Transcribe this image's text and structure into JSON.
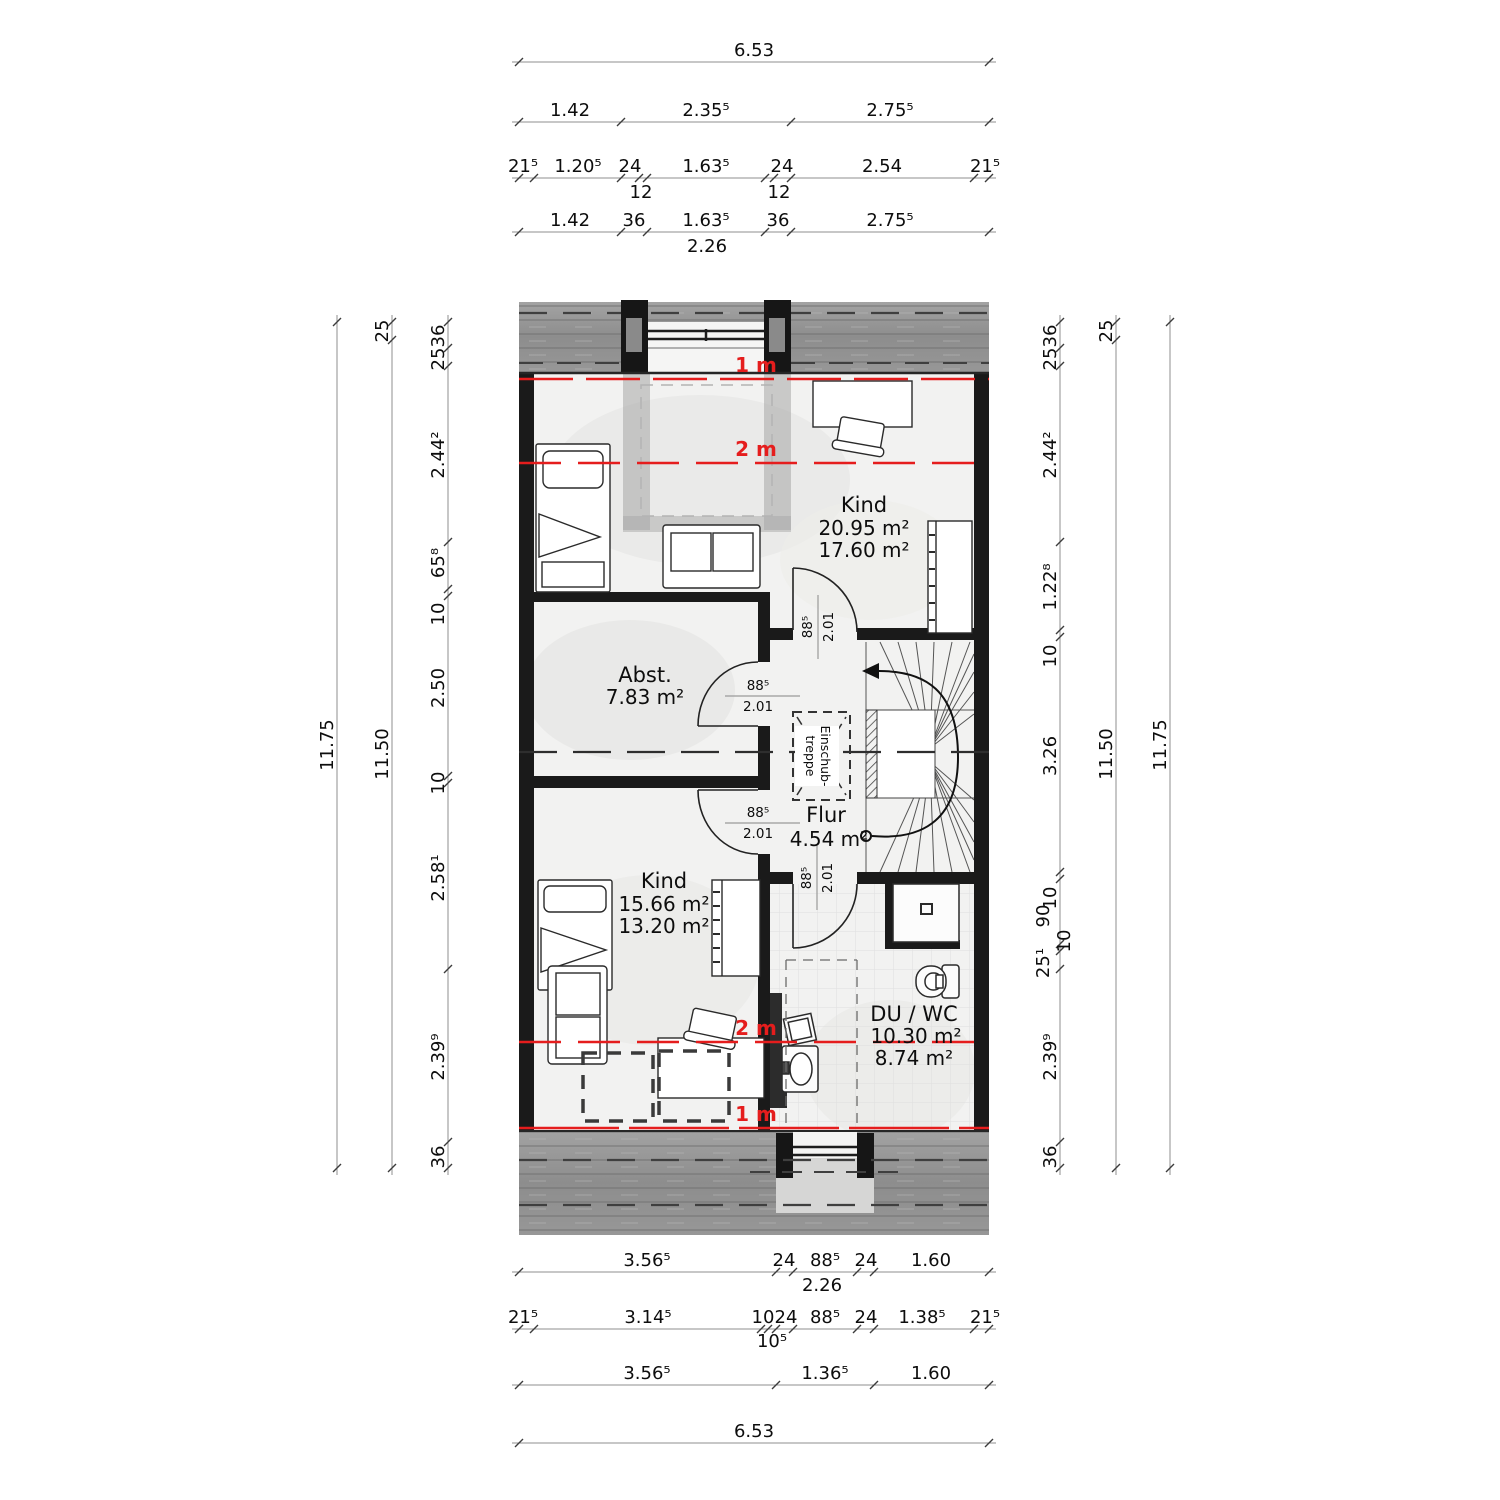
{
  "drawing": {
    "type": "floor-plan",
    "rooms": {
      "kind_top": {
        "name": "Kind",
        "area1": "20.95 m²",
        "area2": "17.60 m²"
      },
      "abst": {
        "name": "Abst.",
        "area1": "7.83 m²"
      },
      "flur": {
        "name": "Flur",
        "area1": "4.54 m²"
      },
      "kind_bottom": {
        "name": "Kind",
        "area1": "15.66 m²",
        "area2": "13.20 m²"
      },
      "du_wc": {
        "name": "DU / WC",
        "area1": "10.30 m²",
        "area2": "8.74 m²"
      }
    },
    "doors": {
      "width": "88⁵",
      "height": "2.01"
    },
    "heights": {
      "one": "1 m",
      "two": "2 m"
    },
    "stair": {
      "label1": "Einschub-",
      "label2": "treppe"
    },
    "dims": {
      "top": {
        "row1": "6.53",
        "row2": [
          "1.42",
          "2.35⁵",
          "2.75⁵"
        ],
        "row3": [
          "21⁵",
          "1.20⁵",
          "24",
          "1.63⁵",
          "24",
          "2.54",
          "21⁵"
        ],
        "row3_sub": [
          "12",
          "12"
        ],
        "row4": [
          "1.42",
          "36",
          "1.63⁵",
          "36",
          "2.75⁵"
        ],
        "row4_sub": "2.26"
      },
      "bottom": {
        "row1": [
          "3.56⁵",
          "24",
          "88⁵",
          "24",
          "1.60"
        ],
        "row1_sub": "2.26",
        "row2": [
          "21⁵",
          "3.14⁵",
          "10",
          "24",
          "88⁵",
          "24",
          "1.38⁵",
          "21⁵"
        ],
        "row2_sub": "10⁵",
        "row3": [
          "3.56⁵",
          "1.36⁵",
          "1.60"
        ],
        "row4": "6.53"
      },
      "left": {
        "outer": "11.75",
        "middle": [
          "25",
          "11.50"
        ],
        "inner": [
          "36",
          "25",
          "2.44²",
          "65⁸",
          "10",
          "2.50",
          "10",
          "2.58¹",
          "2.39⁹",
          "36"
        ]
      },
      "right": {
        "inner": [
          "36",
          "25",
          "2.44²",
          "1.22⁸",
          "10",
          "3.26",
          "10",
          "90",
          "10",
          "25¹",
          "2.39⁹",
          "36"
        ],
        "middle": [
          "25",
          "11.50"
        ],
        "outer": "11.75"
      }
    },
    "colors": {
      "accent_red": "#e51d1d",
      "wall": "#1a1a1a",
      "roof": "#8f8f8f"
    }
  }
}
